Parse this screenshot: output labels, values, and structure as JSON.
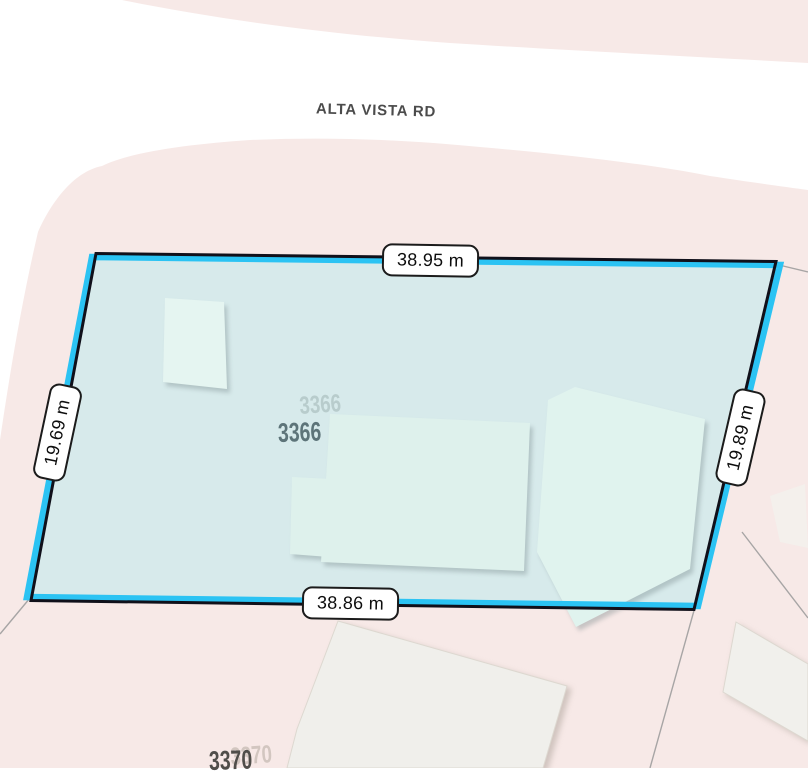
{
  "map": {
    "road": {
      "name": "ALTA VISTA RD"
    },
    "selected_parcel": {
      "address": "3366",
      "ghost_address": "3366",
      "dimensions": {
        "top": "38.95 m",
        "bottom": "38.86 m",
        "left": "19.69 m",
        "right": "19.89 m"
      }
    },
    "neighbor_parcel": {
      "address": "3370",
      "ghost_address": "3370"
    },
    "colors": {
      "road_white": "#ffffff",
      "block_pink": "#f7e9e7",
      "parcel_fill": "#d7eaeb",
      "selection_cyan": "#2bc3f3",
      "boundary_black": "#10101a",
      "building_mint": "#def1ec",
      "neighbor_building": "#f0efeb",
      "parcel_line_gray": "#9a9a9a"
    }
  }
}
